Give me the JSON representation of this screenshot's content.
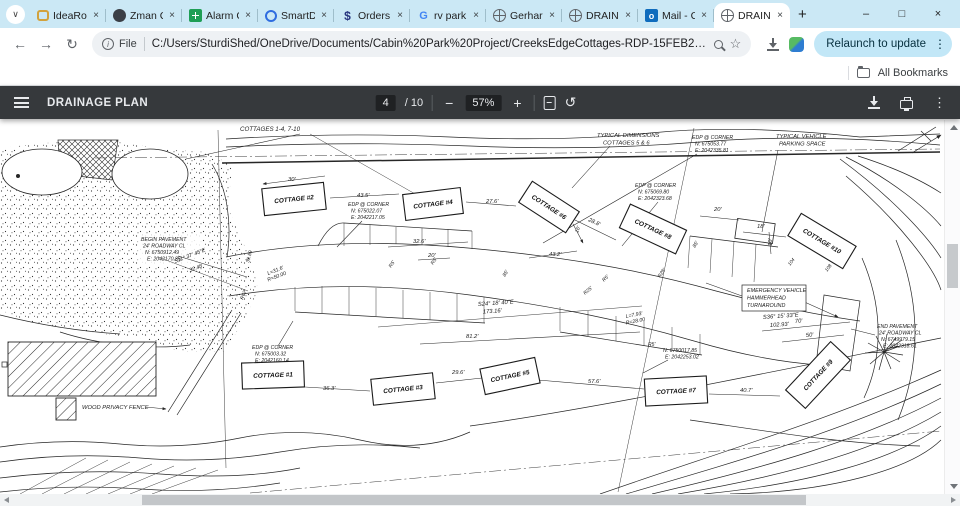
{
  "icons": {
    "back": "←",
    "forward": "→",
    "reload": "↻",
    "close": "×",
    "minimize": "–",
    "maximize": "□",
    "plus": "+",
    "minus": "−",
    "kebab": "⋮",
    "rotate": "↺",
    "chevron": "∨",
    "star": "☆",
    "info": "i"
  },
  "browser": {
    "tabs": [
      {
        "title": "IdeaRo",
        "icon": "fi-chat",
        "icon_name": "chat-favicon"
      },
      {
        "title": "Zman C",
        "icon": "fi-clock",
        "icon_name": "clock-favicon"
      },
      {
        "title": "Alarm C",
        "icon": "fi-sheet",
        "icon_name": "spreadsheet-favicon"
      },
      {
        "title": "SmartD",
        "icon": "fi-smart",
        "icon_name": "smartthings-favicon"
      },
      {
        "title": "Orders",
        "icon": "fi-dollar",
        "icon_name": "dollar-favicon",
        "glyph": "$"
      },
      {
        "title": "rv park",
        "icon": "fi-g",
        "icon_name": "google-favicon",
        "glyph": "G"
      },
      {
        "title": "Gerhar",
        "icon": "fi-globe",
        "icon_name": "globe-favicon"
      },
      {
        "title": "DRAIN",
        "icon": "fi-globe",
        "icon_name": "globe-favicon"
      },
      {
        "title": "Mail - C",
        "icon": "fi-mail",
        "icon_name": "outlook-favicon",
        "glyph": "o"
      },
      {
        "title": "DRAIN",
        "icon": "fi-globe",
        "icon_name": "globe-favicon",
        "active": true
      }
    ],
    "address": {
      "scheme_label": "File",
      "url": "C:/Users/SturdiShed/OneDrive/Documents/Cabin%20Park%20Project/CreeksEdgeCottages-RDP-15FEB2024[9641].pdf"
    },
    "relaunch_label": "Relaunch to update",
    "bookmarks": {
      "all_label": "All Bookmarks"
    }
  },
  "pdf_toolbar": {
    "title": "DRAINAGE PLAN",
    "page_current": "4",
    "page_total": "/ 10",
    "zoom_value": "57%"
  },
  "plan": {
    "cottages": [
      {
        "label": "COTTAGE #1",
        "x": 273,
        "y": 375,
        "w": 62,
        "h": 26,
        "rot": -2
      },
      {
        "label": "COTTAGE #2",
        "x": 294,
        "y": 199,
        "w": 62,
        "h": 27,
        "rot": -6
      },
      {
        "label": "COTTAGE #3",
        "x": 403,
        "y": 389,
        "w": 62,
        "h": 26,
        "rot": -6
      },
      {
        "label": "COTTAGE #4",
        "x": 433,
        "y": 204,
        "w": 58,
        "h": 26,
        "rot": -7
      },
      {
        "label": "COTTAGE #5",
        "x": 510,
        "y": 376,
        "w": 56,
        "h": 26,
        "rot": -12
      },
      {
        "label": "COTTAGE #6",
        "x": 549,
        "y": 207,
        "w": 56,
        "h": 25,
        "rot": 33
      },
      {
        "label": "COTTAGE #7",
        "x": 676,
        "y": 391,
        "w": 62,
        "h": 27,
        "rot": -3
      },
      {
        "label": "COTTAGE #8",
        "x": 653,
        "y": 229,
        "w": 62,
        "h": 26,
        "rot": 25
      },
      {
        "label": "COTTAGE #9",
        "x": 818,
        "y": 375,
        "w": 66,
        "h": 27,
        "rot": -47
      },
      {
        "label": "COTTAGE #10",
        "x": 822,
        "y": 241,
        "w": 64,
        "h": 26,
        "rot": 31
      }
    ],
    "labels": [
      {
        "t": "COTTAGES 1-4, 7-10",
        "x": 240,
        "y": 131,
        "s": 6.2
      },
      {
        "t": "TYPICAL DIMENSIONS",
        "x": 597,
        "y": 137
      },
      {
        "t": "COTTAGES 5 & 6",
        "x": 603,
        "y": 144.5
      },
      {
        "t": "EDP @ CORNER",
        "x": 692,
        "y": 139,
        "s": 5.2
      },
      {
        "t": "N: 675053.77",
        "x": 695,
        "y": 145.5,
        "s": 5.2
      },
      {
        "t": "E: 2042335.81",
        "x": 695,
        "y": 152,
        "s": 5.2
      },
      {
        "t": "TYPICAL VEHICLE",
        "x": 776,
        "y": 138
      },
      {
        "t": "PARKING SPACE",
        "x": 779,
        "y": 145.5
      },
      {
        "t": "EDP @ CORNER",
        "x": 635,
        "y": 187,
        "s": 5.2
      },
      {
        "t": "N: 675069.80",
        "x": 638,
        "y": 193.5,
        "s": 5.2
      },
      {
        "t": "E: 2042323.68",
        "x": 638,
        "y": 200,
        "s": 5.2
      },
      {
        "t": "EDP @ CORNER",
        "x": 348,
        "y": 206,
        "s": 5.2
      },
      {
        "t": "N: 675022.07",
        "x": 351,
        "y": 212.5,
        "s": 5.2
      },
      {
        "t": "E: 2042217.05",
        "x": 351,
        "y": 219,
        "s": 5.2
      },
      {
        "t": "BEGIN PAVEMENT",
        "x": 141,
        "y": 241,
        "s": 5.2
      },
      {
        "t": "24' ROADWAY CL",
        "x": 143,
        "y": 247.5,
        "s": 5.2
      },
      {
        "t": "N: 6750912.49",
        "x": 145,
        "y": 254,
        "s": 5.2
      },
      {
        "t": "E: 2042170.85",
        "x": 147,
        "y": 260.5,
        "s": 5.2
      },
      {
        "t": "EDP @ CORNER",
        "x": 252,
        "y": 349,
        "s": 5.2
      },
      {
        "t": "N: 675003.32",
        "x": 255,
        "y": 355.5,
        "s": 5.2
      },
      {
        "t": "E: 2042160.14",
        "x": 255,
        "y": 362,
        "s": 5.2
      },
      {
        "t": "N: 6750017.85",
        "x": 663,
        "y": 352,
        "s": 5.2
      },
      {
        "t": "E: 2042253.02",
        "x": 665,
        "y": 358.5,
        "s": 5.2
      },
      {
        "t": "END PAVEMENT",
        "x": 877,
        "y": 328,
        "s": 5.2
      },
      {
        "t": "24' ROADWAY CL",
        "x": 879,
        "y": 334.5,
        "s": 5.2
      },
      {
        "t": "N: 6749979.15",
        "x": 881,
        "y": 341,
        "s": 5.2
      },
      {
        "t": "E: 2042318.61",
        "x": 883,
        "y": 347.5,
        "s": 5.2
      },
      {
        "t": "EMERGENCY VEHICLE",
        "x": 747,
        "y": 292,
        "s": 5.4
      },
      {
        "t": "HAMMERHEAD",
        "x": 747,
        "y": 299.5,
        "s": 5.4
      },
      {
        "t": "TURNAROUND",
        "x": 747,
        "y": 307,
        "s": 5.4
      },
      {
        "t": "S36° 15' 33\"E",
        "x": 763,
        "y": 319,
        "r": -4
      },
      {
        "t": "102.93'",
        "x": 770,
        "y": 327,
        "r": -4
      },
      {
        "t": "S24° 18' 40\"E",
        "x": 478,
        "y": 306,
        "r": -4
      },
      {
        "t": "173.16'",
        "x": 483,
        "y": 313.5,
        "r": -4
      },
      {
        "t": "S11° 37' 45\"E",
        "x": 175,
        "y": 263,
        "r": -21,
        "s": 5.4
      },
      {
        "t": "32.48",
        "x": 190,
        "y": 272,
        "r": -21,
        "s": 5.4
      },
      {
        "t": "L=31.6'",
        "x": 268,
        "y": 275,
        "r": -21,
        "s": 5.2
      },
      {
        "t": "R=50.00",
        "x": 268,
        "y": 281.5,
        "r": -21,
        "s": 5.2
      },
      {
        "t": "L=7.93'",
        "x": 626,
        "y": 318,
        "r": -11,
        "s": 5.2
      },
      {
        "t": "R=28.00",
        "x": 626,
        "y": 324.5,
        "r": -11,
        "s": 5.2
      },
      {
        "t": "WOOD PRIVACY FENCE",
        "x": 82,
        "y": 409,
        "s": 5.8
      },
      {
        "t": "30'",
        "x": 288,
        "y": 181
      },
      {
        "t": "43.5'",
        "x": 357,
        "y": 197
      },
      {
        "t": "27.6'",
        "x": 486,
        "y": 203
      },
      {
        "t": "28.8'",
        "x": 588,
        "y": 221,
        "r": 25
      },
      {
        "t": "20'",
        "x": 714,
        "y": 211
      },
      {
        "t": "18'",
        "x": 757,
        "y": 228
      },
      {
        "t": "10'",
        "x": 772,
        "y": 246,
        "r": -90
      },
      {
        "t": "32.6'",
        "x": 413,
        "y": 243
      },
      {
        "t": "20'",
        "x": 428,
        "y": 257
      },
      {
        "t": "43.2'",
        "x": 549,
        "y": 256
      },
      {
        "t": "36.3'",
        "x": 323,
        "y": 390
      },
      {
        "t": "29.6'",
        "x": 452,
        "y": 374
      },
      {
        "t": "57.6'",
        "x": 588,
        "y": 383
      },
      {
        "t": "40.7'",
        "x": 740,
        "y": 392
      },
      {
        "t": "81.2'",
        "x": 466,
        "y": 338
      },
      {
        "t": "70'",
        "x": 795,
        "y": 323,
        "r": -5
      },
      {
        "t": "50'",
        "x": 806,
        "y": 337,
        "r": -5
      },
      {
        "t": "R5'",
        "x": 391,
        "y": 268,
        "r": -55,
        "s": 5
      },
      {
        "t": "R5'",
        "x": 433,
        "y": 265,
        "r": -55,
        "s": 5
      },
      {
        "t": "R5'",
        "x": 604,
        "y": 282,
        "r": -45,
        "s": 5
      },
      {
        "t": "R25'",
        "x": 585,
        "y": 295,
        "r": -40,
        "s": 5
      },
      {
        "t": "R28'",
        "x": 660,
        "y": 278,
        "r": -55,
        "s": 5
      },
      {
        "t": "R62'",
        "x": 243,
        "y": 300,
        "r": -68,
        "s": 5
      },
      {
        "t": "R5'",
        "x": 648,
        "y": 346,
        "s": 5
      },
      {
        "t": "85'",
        "x": 505,
        "y": 277,
        "r": -58,
        "s": 5
      },
      {
        "t": "85'",
        "x": 695,
        "y": 248,
        "r": -58,
        "s": 5
      },
      {
        "t": "104",
        "x": 790,
        "y": 266,
        "r": -52,
        "s": 4.8
      },
      {
        "t": "108",
        "x": 827,
        "y": 272,
        "r": -52,
        "s": 4.8
      },
      {
        "t": "39.89",
        "x": 249,
        "y": 263,
        "r": -75,
        "s": 5
      },
      {
        "t": "16'",
        "x": 578,
        "y": 233,
        "r": -70,
        "s": 5
      }
    ]
  }
}
